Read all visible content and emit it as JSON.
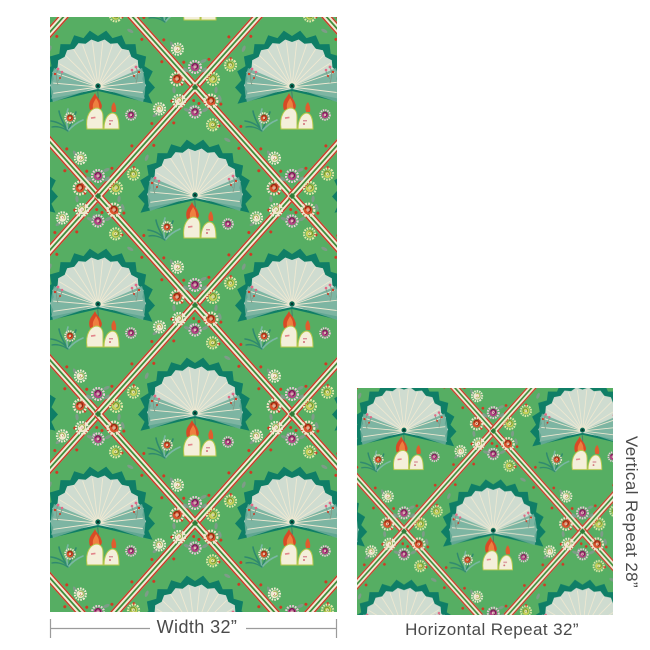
{
  "title": "Wallpaper dimensions specification",
  "labels": {
    "width": "Width 32”",
    "horizontal_repeat": "Horizontal Repeat 32”",
    "vertical_repeat": "Vertical Repeat 28”"
  },
  "dimensions": {
    "width_inches": 32,
    "horizontal_repeat_inches": 32,
    "vertical_repeat_inches": 28
  },
  "pattern": {
    "description": "Green chinoiserie wallpaper: teal fan medallions over flaming rocks, diamond ribbon trellis with multicolor pompom blossoms, leaf vines and red dots",
    "palette": {
      "background_green": "#56ae63",
      "fan_dark_teal": "#0f7e66",
      "fan_mid_teal": "#6fae9a",
      "fan_pale": "#cfdcd0",
      "ray_cream": "#efe9d2",
      "ribbon_cream": "#f1ead3",
      "ribbon_red": "#c93a28",
      "ribbon_green": "#3e8e3c",
      "blossom_orange": "#d9542e",
      "blossom_magenta": "#b34485",
      "blossom_cream": "#efe8cd",
      "blossom_chartreuse": "#c5cf5a",
      "leaf_gray_green": "#7e9c88",
      "dot_red": "#cf3a24",
      "flame_red": "#d84a26",
      "flame_orange": "#ee8040",
      "rock_cream": "#f4efda",
      "rock_outline": "#b9c84a",
      "text_gray": "#4a4a4a",
      "dimension_line_gray": "#9b9b9b"
    }
  }
}
